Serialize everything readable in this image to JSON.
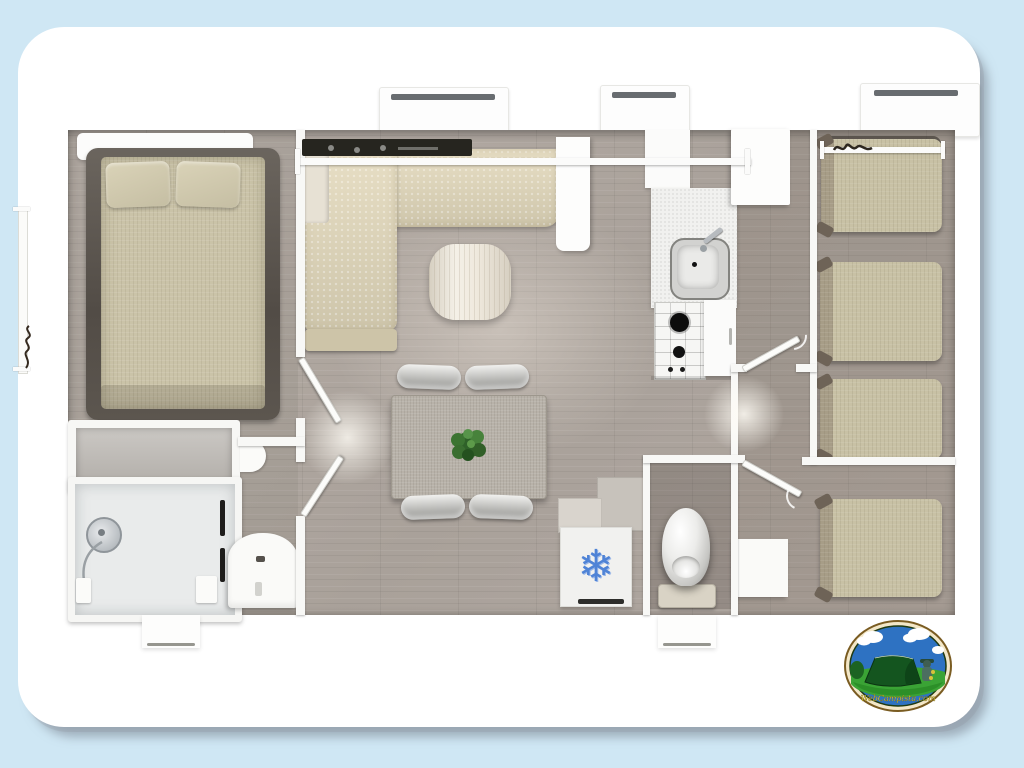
{
  "scene": {
    "kind": "mobile-home floor plan, 3D top-down render on white rounded card",
    "background_color": "#cfe7f4",
    "card_color": "#ffffff"
  },
  "palette": {
    "floor_wood": "#aca39c",
    "wall_white": "#f8f8f6",
    "mattress_beige": "#cac3a8",
    "sofa_beige": "#d9d0b4",
    "dining_table_gray": "#b8b2a9",
    "plant_green": "#3f7a36",
    "snowflake_blue": "#4f83d6",
    "shadow_gray": "#76808c"
  },
  "icons": {
    "freezer_glyph": "❄"
  },
  "logo": {
    "text": "WebCampista.com",
    "ring_color": "#7a5c22",
    "sky_color": "#2e72c2",
    "grass_color": "#3aa335",
    "tent_color": "#14551f",
    "text_color": "#ead83f"
  },
  "rooms": [
    {
      "name": "master-bedroom",
      "furniture": [
        "double-bed",
        "headboard",
        "two-pillows"
      ]
    },
    {
      "name": "living-area",
      "furniture": [
        "corner-sofa",
        "coffee-table",
        "dining-table",
        "four-chairs",
        "plant"
      ]
    },
    {
      "name": "kitchen",
      "furniture": [
        "sink",
        "gas-hob-2-burners",
        "cabinets",
        "fridge-freezer"
      ]
    },
    {
      "name": "bathroom",
      "furniture": [
        "wardrobe",
        "shower-cabin",
        "washbasin"
      ]
    },
    {
      "name": "toilet-room",
      "furniture": [
        "toilet"
      ]
    },
    {
      "name": "bedroom-right-top",
      "furniture": [
        "single-bed",
        "single-bed"
      ]
    },
    {
      "name": "bedroom-right-bottom",
      "furniture": [
        "single-bed",
        "single-bed",
        "bedside-cabinet"
      ]
    }
  ],
  "counts": {
    "top_windows": 3,
    "entrance_steps": 2,
    "interior_doors": 4,
    "single_beds": 4
  }
}
